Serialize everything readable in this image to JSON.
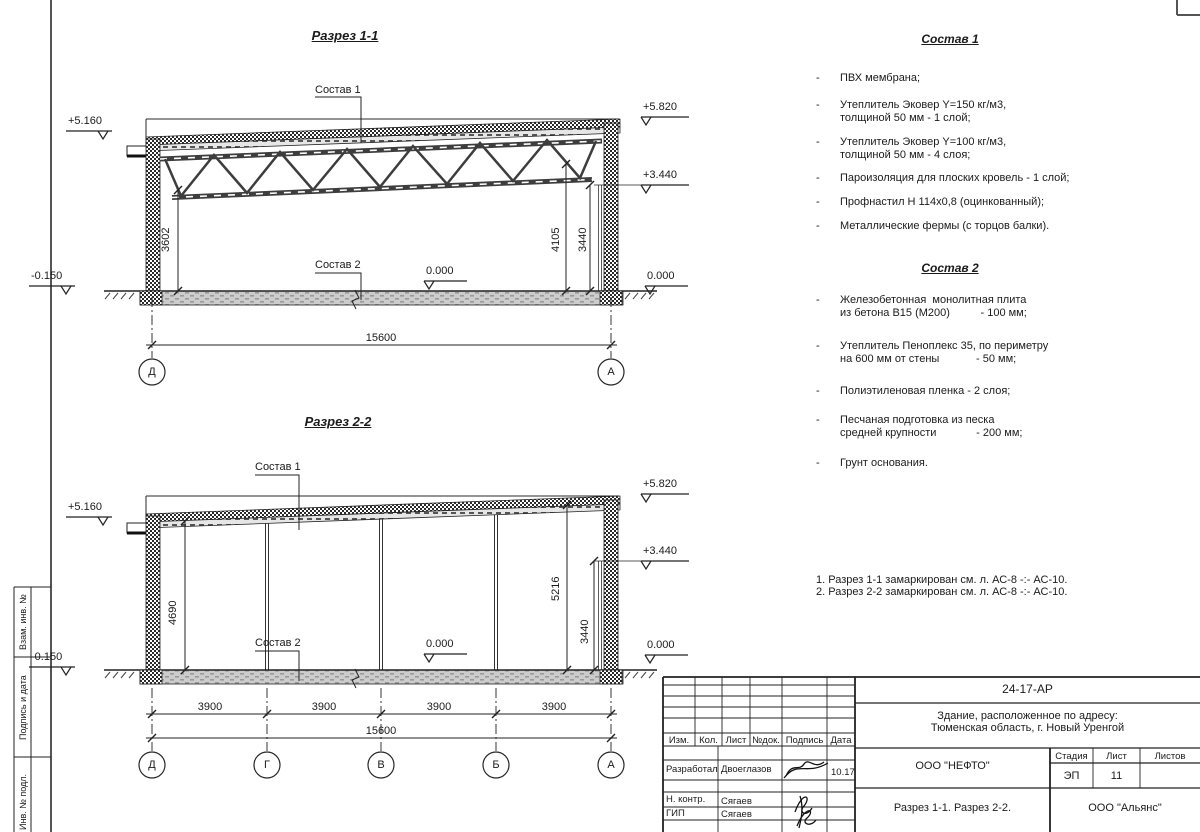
{
  "section1": {
    "title": "Разрез 1-1",
    "composition1_label": "Состав 1",
    "composition2_label": "Состав 2",
    "elevations": {
      "left_top": "+5.160",
      "left_bottom": "-0.150",
      "right_top": "+5.820",
      "right_mid": "+3.440",
      "right_zero": "0.000",
      "floor_zero": "0.000"
    },
    "dimensions": {
      "left_height": "3602",
      "right_height_outer": "4105",
      "right_height_inner": "3440",
      "span": "15600"
    },
    "axes": [
      "Д",
      "А"
    ]
  },
  "section2": {
    "title": "Разрез 2-2",
    "composition1_label": "Состав 1",
    "composition2_label": "Состав 2",
    "elevations": {
      "left_top": "+5.160",
      "left_bottom": "-0.150",
      "right_top": "+5.820",
      "right_mid": "+3.440",
      "right_zero": "0.000",
      "floor_zero": "0.000"
    },
    "dimensions": {
      "left_height": "4690",
      "right_height_outer": "5216",
      "right_height_inner": "3440",
      "bays": [
        "3900",
        "3900",
        "3900",
        "3900"
      ],
      "span": "15600"
    },
    "axes": [
      "Д",
      "Г",
      "В",
      "Б",
      "А"
    ]
  },
  "composition1": {
    "title": "Состав 1",
    "bullet": "-",
    "items": [
      {
        "line1": "ПВХ мембрана;",
        "line2": ""
      },
      {
        "line1": "Утеплитель Эковер Y=150 кг/м3,",
        "line2": "толщиной 50 мм - 1 слой;"
      },
      {
        "line1": "Утеплитель Эковер Y=100 кг/м3,",
        "line2": "толщиной 50 мм - 4 слоя;"
      },
      {
        "line1": "Пароизоляция для плоских кровель - 1 слой;",
        "line2": ""
      },
      {
        "line1": "Профнастил Н 114х0,8 (оцинкованный);",
        "line2": ""
      },
      {
        "line1": "Металлические фермы (с торцов балки).",
        "line2": ""
      }
    ]
  },
  "composition2": {
    "title": "Состав 2",
    "bullet": "-",
    "items": [
      {
        "line1": "Железобетонная  монолитная плита",
        "line2": "из бетона В15 (М200)          - 100 мм;"
      },
      {
        "line1": "Утеплитель Пеноплекс 35, по периметру",
        "line2": "на 600 мм от стены            - 50 мм;"
      },
      {
        "line1": "Полиэтиленовая пленка - 2 слоя;",
        "line2": ""
      },
      {
        "line1": "Песчаная подготовка из песка",
        "line2": "средней крупности             - 200 мм;"
      },
      {
        "line1": "Грунт основания.",
        "line2": ""
      }
    ]
  },
  "notes": {
    "line1": "1. Разрез 1-1 замаркирован см. л. АС-8 -:- АС-10.",
    "line2": "2. Разрез 2-2 замаркирован см. л. АС-8 -:- АС-10."
  },
  "margin": {
    "label1": "Взам. инв. №",
    "label2": "Подпись и дата",
    "label3": "Инв. № подл."
  },
  "titleblock": {
    "document_code": "24-17-АР",
    "project_line1": "Здание, расположенное по адресу:",
    "project_line2": "Тюменская область, г. Новый Уренгой",
    "columns": {
      "izm": "Изм.",
      "kol": "Кол.",
      "list": "Лист",
      "ndok": "№док.",
      "podpis": "Подпись",
      "data": "Дата"
    },
    "roles": {
      "developed_label": "Разработал",
      "developed_name": "Двоеглазов",
      "developed_date": "10.17",
      "ncontrol_label": "Н. контр.",
      "ncontrol_name": "Сягаев",
      "gip_label": "ГИП",
      "gip_name": "Сягаев"
    },
    "designer_company": "ООО \"НЕФТО\"",
    "stage_label": "Стадия",
    "sheet_label": "Лист",
    "sheets_label": "Листов",
    "stage_value": "ЭП",
    "sheet_value": "11",
    "sheets_value": "",
    "sheet_caption": "Разрез 1-1. Разрез 2-2.",
    "contractor_company": "ООО \"Альянс\""
  }
}
